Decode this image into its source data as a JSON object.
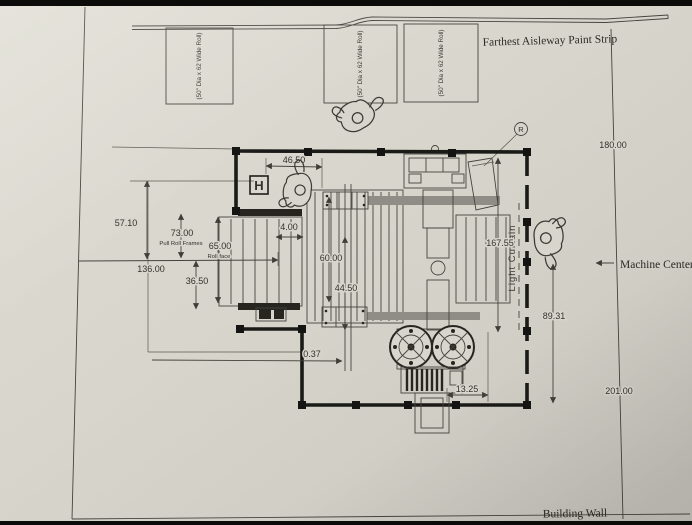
{
  "labels": {
    "aisleway": "Farthest Aisleway Paint Strip",
    "machine_center": "Machine Centerl",
    "building_wall": "Building Wall",
    "light_curtain": "Light Curtain",
    "pull_roll_frames": "Pull Roll Frames",
    "roll_face": "Roll face",
    "h_marker": "H",
    "balloon": "R",
    "roll_note": "(50\" Dia x 62 Wide Roll)"
  },
  "dims": {
    "d4650": "46.50",
    "d5710": "57.10",
    "d7300": "73.00",
    "d6500": "65.00",
    "d13600": "136.00",
    "d3650": "36.50",
    "d400": "4.00",
    "d6000": "60.00",
    "d4450": "44.50",
    "d16755": "167.55",
    "d8931": "89.31",
    "d18000": "180.00",
    "d20100": "201.00",
    "d1325": "13.25",
    "d037": "0.37"
  },
  "colors": {
    "paper": "#d8d6cc",
    "line": "#45443e",
    "ink": "#32312c",
    "fence": "#1a1a17",
    "gray_strip": "#8f8d85",
    "background": "#0b0b0a"
  }
}
